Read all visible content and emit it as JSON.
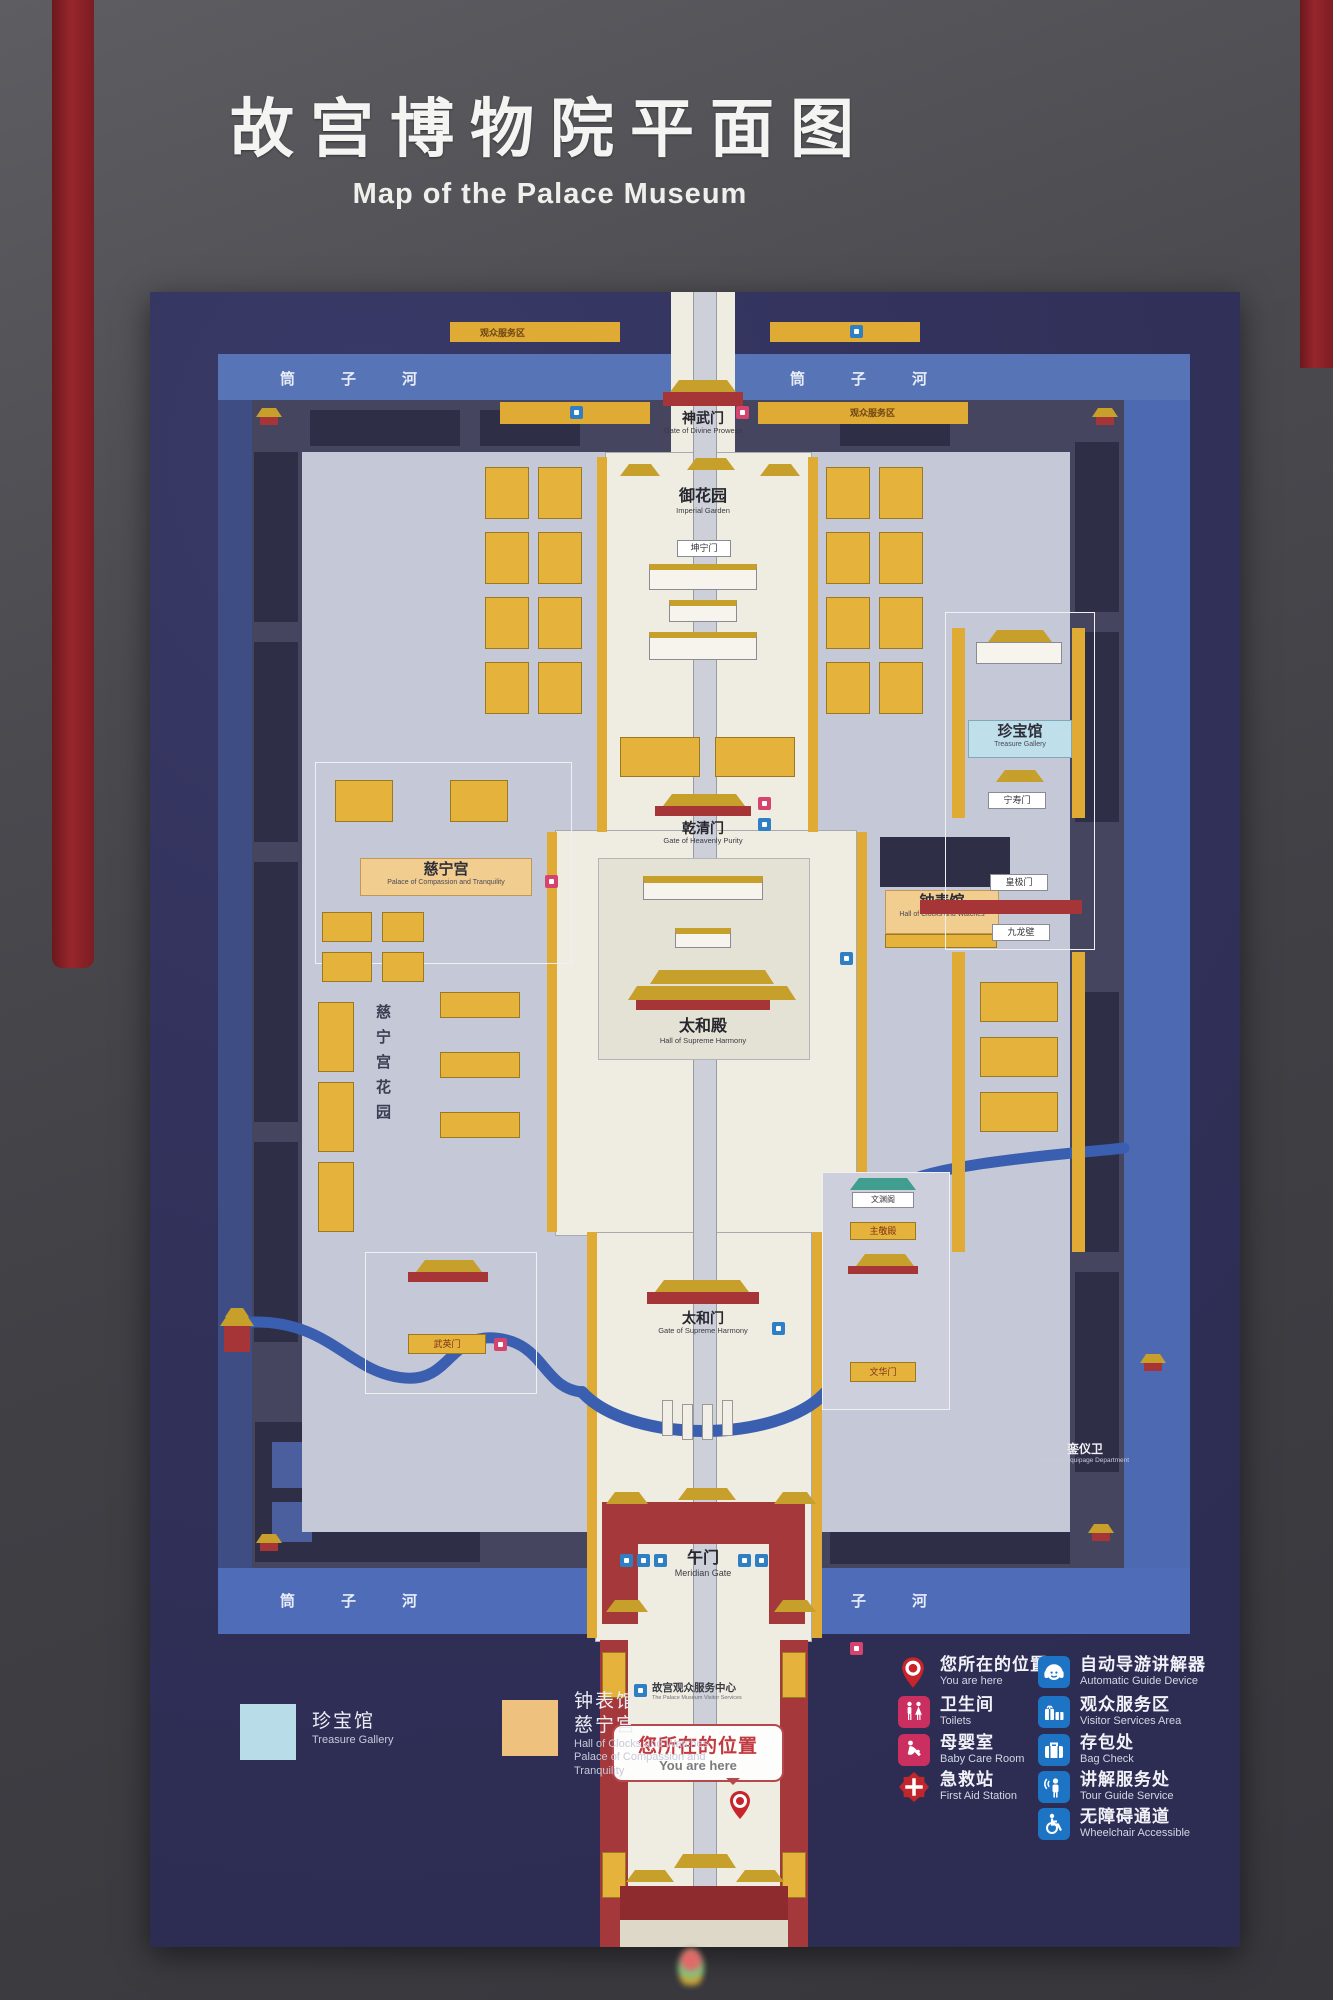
{
  "sign": {
    "title_zh": "故宫博物院平面图",
    "title_en": "Map of the Palace Museum"
  },
  "map": {
    "moat_label": "筒子河",
    "service_band_label": "观众服务区",
    "you_are_here": {
      "zh": "您所在的位置",
      "en": "You are here"
    },
    "places": {
      "shenwumen": {
        "zh": "神武门",
        "en": "Gate of Divine Prowess"
      },
      "imperial_garden": {
        "zh": "御花园",
        "en": "Imperial Garden"
      },
      "kunningmen": {
        "zh": "坤宁门"
      },
      "qianqingmen": {
        "zh": "乾清门",
        "en": "Gate of Heavenly Purity"
      },
      "taihedian": {
        "zh": "太和殿",
        "en": "Hall of Supreme Harmony"
      },
      "taihemen": {
        "zh": "太和门",
        "en": "Gate of Supreme Harmony"
      },
      "wumen": {
        "zh": "午门",
        "en": "Meridian Gate"
      },
      "treasure_gallery": {
        "zh": "珍宝馆",
        "en": "Treasure Gallery"
      },
      "clock_hall": {
        "zh": "钟表馆",
        "en": "Hall of Clocks and Watches"
      },
      "cininggong": {
        "zh": "慈宁宫",
        "en": "Palace of Compassion and Tranquility"
      },
      "cining_garden": {
        "zh": "慈宁宫花园"
      },
      "ningshoumen": {
        "zh": "宁寿门"
      },
      "huangjimen": {
        "zh": "皇极门"
      },
      "nine_dragon_screen": {
        "zh": "九龙壁"
      },
      "wuyingmen": {
        "zh": "武英门"
      },
      "wenhuamen": {
        "zh": "文华门"
      },
      "wenyuange": {
        "zh": "文渊阁"
      },
      "zhujingdian": {
        "zh": "主敬殿"
      },
      "luanyiwei": {
        "zh": "銮仪卫",
        "en": "Imperial Equipage Department"
      },
      "visitor_center": {
        "zh": "故宫观众服务中心",
        "en": "The Palace Museum Visitor Services"
      }
    }
  },
  "legend_left": {
    "items": [
      {
        "zh": "珍宝馆",
        "en": "Treasure Gallery",
        "color": "#b9dce9"
      },
      {
        "zh1": "钟表馆",
        "zh2": "慈宁宫",
        "en1": "Hall of Clocks and Watches",
        "en2": "Palace of Compassion and Tranquility",
        "color": "#eec27e"
      }
    ]
  },
  "legend_right": {
    "left_column": [
      {
        "zh": "您所在的位置",
        "en": "You are here"
      },
      {
        "zh": "卫生间",
        "en": "Toilets"
      },
      {
        "zh": "母婴室",
        "en": "Baby Care Room"
      },
      {
        "zh": "急救站",
        "en": "First Aid Station"
      }
    ],
    "right_column": [
      {
        "zh": "自动导游讲解器",
        "en": "Automatic Guide Device"
      },
      {
        "zh": "观众服务区",
        "en": "Visitor Services Area"
      },
      {
        "zh": "存包处",
        "en": "Bag Check"
      },
      {
        "zh": "讲解服务处",
        "en": "Tour Guide Service"
      },
      {
        "zh": "无障碍通道",
        "en": "Wheelchair Accessible"
      }
    ]
  }
}
